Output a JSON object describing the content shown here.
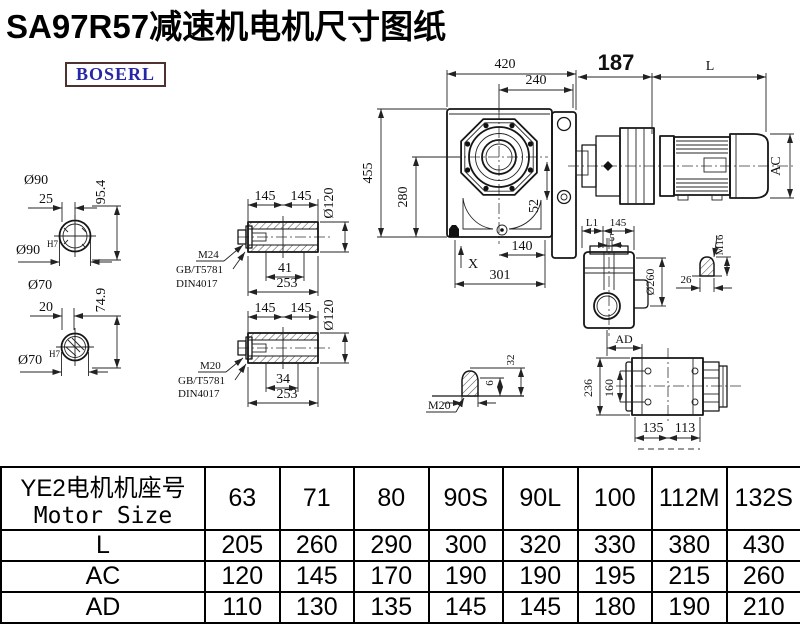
{
  "title": "SA97R57减速机电机尺寸图纸",
  "brand": {
    "logo_text": "BOSERL"
  },
  "drawing": {
    "front_view": {
      "width_total": "420",
      "width_flange": "240",
      "height_total": "455",
      "height_center": "280",
      "hole_offset": "52",
      "base_hole": "140",
      "base_width": "301",
      "x_mark": "X"
    },
    "motor_view": {
      "adapter_length": "187",
      "motor_length": "L",
      "motor_diameter": "AC"
    },
    "shaft90": {
      "dia_label": "Ø90",
      "key_len": "25",
      "height": "95.4",
      "bore": "Ø90",
      "bore_tol": "H7"
    },
    "shaft70": {
      "dia_label": "Ø70",
      "key_len": "20",
      "height": "74.9",
      "bore": "Ø70",
      "bore_tol": "H7"
    },
    "bushing_top": {
      "len_half_1": "145",
      "len_half_2": "145",
      "dia": "Ø120",
      "bolt_len": "41",
      "len_total": "253",
      "thread": "M24",
      "standard_1": "GB/T5781",
      "standard_2": "DIN4017"
    },
    "bushing_bottom": {
      "len_half_1": "145",
      "len_half_2": "145",
      "dia": "Ø120",
      "bolt_len": "34",
      "len_total": "253",
      "thread": "M20",
      "standard_1": "GB/T5781",
      "standard_2": "DIN4017"
    },
    "side_view": {
      "l1": "L1",
      "d145": "145",
      "d5": "5",
      "flange_dia": "Ø260",
      "ad": "AD"
    },
    "m16_detail": {
      "thread": "M16",
      "d26": "26"
    },
    "m20_detail": {
      "thread": "M20",
      "d6": "6",
      "d32": "32"
    },
    "foot_view": {
      "d236": "236",
      "d160": "160",
      "d135": "135",
      "d113": "113"
    }
  },
  "table": {
    "header_cn": "YE2电机机座号",
    "header_en": "Motor Size",
    "columns": [
      "63",
      "71",
      "80",
      "90S",
      "90L",
      "100",
      "112M",
      "132S"
    ],
    "rows": [
      {
        "label": "L",
        "values": [
          "205",
          "260",
          "290",
          "300",
          "320",
          "330",
          "380",
          "430"
        ]
      },
      {
        "label": "AC",
        "values": [
          "120",
          "145",
          "170",
          "190",
          "190",
          "195",
          "215",
          "260"
        ]
      },
      {
        "label": "AD",
        "values": [
          "110",
          "130",
          "135",
          "145",
          "145",
          "180",
          "190",
          "210"
        ]
      }
    ]
  }
}
